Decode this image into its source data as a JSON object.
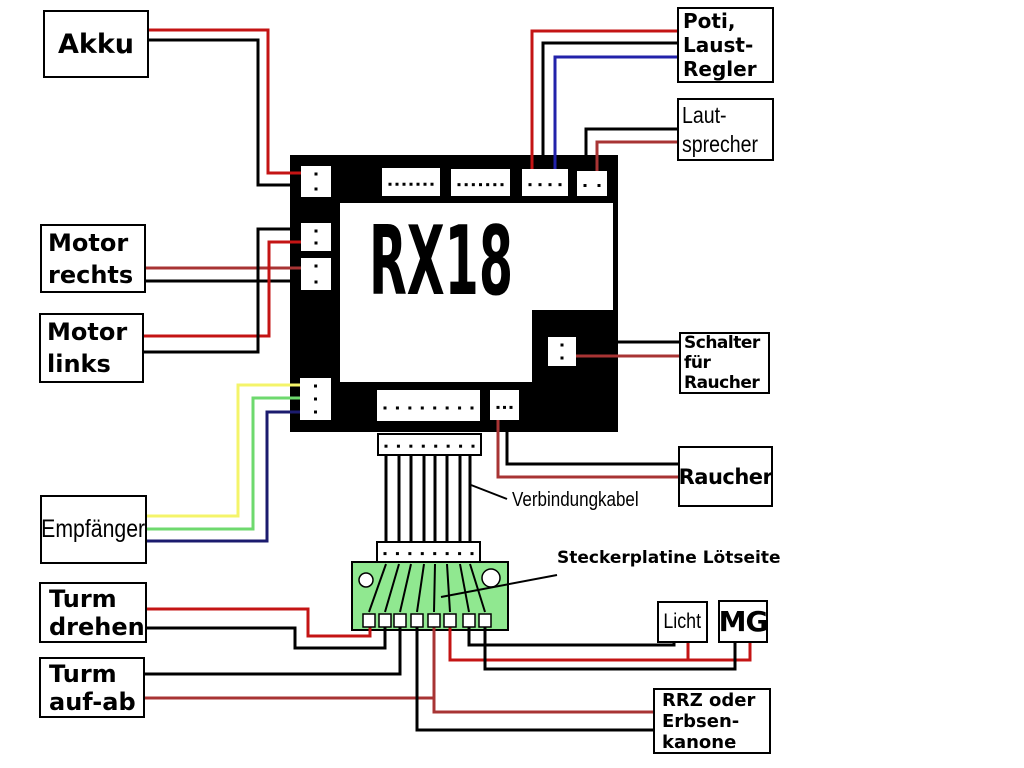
{
  "board": {
    "label": "RX18"
  },
  "boxes": {
    "akku": {
      "lines": [
        "Akku"
      ]
    },
    "poti": {
      "lines": [
        "Poti,",
        "Laust-",
        "Regler"
      ]
    },
    "lautsprecher": {
      "lines": [
        "Laut-",
        "sprecher"
      ]
    },
    "motor_rechts": {
      "lines": [
        "Motor",
        "rechts"
      ]
    },
    "motor_links": {
      "lines": [
        "Motor",
        "links"
      ]
    },
    "schalter_raucher": {
      "lines": [
        "Schalter",
        "für",
        "Raucher"
      ]
    },
    "raucher": {
      "lines": [
        "Raucher"
      ]
    },
    "empfaenger": {
      "lines": [
        "Empfänger"
      ]
    },
    "turm_drehen": {
      "lines": [
        "Turm",
        "drehen"
      ]
    },
    "turm_aufab": {
      "lines": [
        "Turm",
        "auf-ab"
      ]
    },
    "licht": {
      "lines": [
        "Licht"
      ]
    },
    "mg": {
      "lines": [
        "MG"
      ]
    },
    "rrz": {
      "lines": [
        "RRZ oder",
        "Erbsen-",
        "kanone"
      ]
    }
  },
  "annotations": {
    "cable_label": "Verbindungkabel",
    "pcb_label_line1": "Steckerplatine",
    "pcb_label_line2": "Lötseite"
  },
  "colors": {
    "red": "#c41414",
    "dark_red": "#a83434",
    "blue": "#2222aa",
    "navy": "#1b1b6e",
    "yellow": "#f4f46a",
    "green": "#6ed96e",
    "black": "#000000",
    "pcb_green": "#90e890",
    "white": "#ffffff"
  },
  "connectors": [
    {
      "name": "akku-connector",
      "x": 301,
      "y": 166,
      "w": 30,
      "h": 31,
      "pins": 2,
      "orient": "v"
    },
    {
      "name": "top-connector-1",
      "x": 382,
      "y": 168,
      "w": 58,
      "h": 28,
      "pins": 7,
      "orient": "h"
    },
    {
      "name": "top-connector-2",
      "x": 451,
      "y": 169,
      "w": 59,
      "h": 27,
      "pins": 7,
      "orient": "h"
    },
    {
      "name": "poti-connector",
      "x": 522,
      "y": 169,
      "w": 46,
      "h": 27,
      "pins": 4,
      "orient": "h"
    },
    {
      "name": "lautsprecher-connector",
      "x": 577,
      "y": 171,
      "w": 30,
      "h": 25,
      "pins": 2,
      "orient": "h"
    },
    {
      "name": "motor-rechts-connector",
      "x": 301,
      "y": 223,
      "w": 30,
      "h": 28,
      "pins": 2,
      "orient": "v"
    },
    {
      "name": "motor-links-connector",
      "x": 301,
      "y": 258,
      "w": 30,
      "h": 32,
      "pins": 2,
      "orient": "v"
    },
    {
      "name": "empfaenger-connector",
      "x": 300,
      "y": 378,
      "w": 31,
      "h": 42,
      "pins": 3,
      "orient": "v"
    },
    {
      "name": "schalter-connector",
      "x": 548,
      "y": 337,
      "w": 28,
      "h": 29,
      "pins": 2,
      "orient": "v"
    },
    {
      "name": "bottom-connector-long",
      "x": 377,
      "y": 390,
      "w": 103,
      "h": 31,
      "pins": 8,
      "orient": "h"
    },
    {
      "name": "bottom-connector-small",
      "x": 490,
      "y": 390,
      "w": 29,
      "h": 30,
      "pins": 3,
      "orient": "h"
    }
  ],
  "wires": [
    {
      "name": "wire-akku-red",
      "color": "red",
      "points": [
        [
          148,
          30
        ],
        [
          268,
          30
        ],
        [
          268,
          173
        ],
        [
          303,
          173
        ]
      ]
    },
    {
      "name": "wire-akku-black",
      "color": "black",
      "points": [
        [
          148,
          40
        ],
        [
          258,
          40
        ],
        [
          258,
          185
        ],
        [
          303,
          185
        ]
      ]
    },
    {
      "name": "wire-poti-red",
      "color": "red",
      "points": [
        [
          678,
          31
        ],
        [
          532,
          31
        ],
        [
          532,
          170
        ]
      ]
    },
    {
      "name": "wire-poti-black",
      "color": "black",
      "points": [
        [
          678,
          43
        ],
        [
          543,
          43
        ],
        [
          543,
          170
        ]
      ]
    },
    {
      "name": "wire-poti-blue",
      "color": "blue",
      "points": [
        [
          678,
          57
        ],
        [
          555,
          57
        ],
        [
          555,
          170
        ]
      ]
    },
    {
      "name": "wire-lautsprecher-black",
      "color": "black",
      "points": [
        [
          678,
          129
        ],
        [
          586,
          129
        ],
        [
          586,
          172
        ]
      ]
    },
    {
      "name": "wire-lautsprecher-red",
      "color": "dark_red",
      "points": [
        [
          678,
          142
        ],
        [
          597,
          142
        ],
        [
          597,
          172
        ]
      ]
    },
    {
      "name": "wire-motor-rechts-red",
      "color": "dark_red",
      "points": [
        [
          145,
          268
        ],
        [
          303,
          268
        ]
      ]
    },
    {
      "name": "wire-motor-rechts-black",
      "color": "black",
      "points": [
        [
          145,
          281
        ],
        [
          303,
          281
        ]
      ]
    },
    {
      "name": "wire-motor-links-red",
      "color": "red",
      "points": [
        [
          142,
          336
        ],
        [
          269,
          336
        ],
        [
          269,
          242
        ],
        [
          303,
          242
        ]
      ]
    },
    {
      "name": "wire-motor-links-black",
      "color": "black",
      "points": [
        [
          142,
          352
        ],
        [
          258,
          352
        ],
        [
          258,
          229
        ],
        [
          303,
          229
        ]
      ]
    },
    {
      "name": "wire-schalter-black",
      "color": "black",
      "points": [
        [
          617,
          342
        ],
        [
          679,
          342
        ]
      ]
    },
    {
      "name": "wire-schalter-red",
      "color": "dark_red",
      "points": [
        [
          576,
          356
        ],
        [
          679,
          356
        ]
      ]
    },
    {
      "name": "wire-raucher-black",
      "color": "black",
      "points": [
        [
          507,
          428
        ],
        [
          507,
          464
        ],
        [
          678,
          464
        ]
      ]
    },
    {
      "name": "wire-raucher-red",
      "color": "dark_red",
      "points": [
        [
          498,
          418
        ],
        [
          498,
          477
        ],
        [
          678,
          477
        ]
      ]
    },
    {
      "name": "wire-empfaenger-yellow",
      "color": "yellow",
      "points": [
        [
          146,
          516
        ],
        [
          238,
          516
        ],
        [
          238,
          385
        ],
        [
          302,
          385
        ]
      ]
    },
    {
      "name": "wire-empfaenger-green",
      "color": "green",
      "points": [
        [
          146,
          529
        ],
        [
          253,
          529
        ],
        [
          253,
          398
        ],
        [
          302,
          398
        ]
      ]
    },
    {
      "name": "wire-empfaenger-blue",
      "color": "navy",
      "points": [
        [
          146,
          541
        ],
        [
          267,
          541
        ],
        [
          267,
          412
        ],
        [
          302,
          412
        ]
      ]
    },
    {
      "name": "wire-turm-drehen-red",
      "color": "red",
      "points": [
        [
          146,
          609
        ],
        [
          308,
          609
        ],
        [
          308,
          636
        ],
        [
          370,
          636
        ],
        [
          370,
          624
        ]
      ]
    },
    {
      "name": "wire-turm-drehen-black",
      "color": "black",
      "points": [
        [
          146,
          628
        ],
        [
          295,
          628
        ],
        [
          295,
          648
        ],
        [
          385,
          648
        ],
        [
          385,
          624
        ]
      ]
    },
    {
      "name": "wire-turm-aufab-black",
      "color": "black",
      "points": [
        [
          142,
          674
        ],
        [
          400,
          674
        ],
        [
          400,
          624
        ]
      ]
    },
    {
      "name": "wire-turm-aufab-red",
      "color": "dark_red",
      "points": [
        [
          142,
          698
        ],
        [
          434,
          698
        ]
      ]
    },
    {
      "name": "wire-rrz-red",
      "color": "dark_red",
      "points": [
        [
          434,
          624
        ],
        [
          434,
          712
        ],
        [
          655,
          712
        ]
      ]
    },
    {
      "name": "wire-rrz-black",
      "color": "black",
      "points": [
        [
          417,
          624
        ],
        [
          417,
          730
        ],
        [
          655,
          730
        ]
      ]
    },
    {
      "name": "wire-licht-mg-red",
      "color": "red",
      "points": [
        [
          450,
          624
        ],
        [
          450,
          660
        ],
        [
          750,
          660
        ],
        [
          750,
          641
        ]
      ]
    },
    {
      "name": "wire-licht-red-riser",
      "color": "red",
      "points": [
        [
          688,
          641
        ],
        [
          688,
          660
        ]
      ]
    },
    {
      "name": "wire-licht-black",
      "color": "black",
      "points": [
        [
          469,
          624
        ],
        [
          469,
          645
        ],
        [
          674,
          645
        ],
        [
          674,
          641
        ]
      ]
    },
    {
      "name": "wire-mg-black",
      "color": "black",
      "points": [
        [
          485,
          624
        ],
        [
          485,
          669
        ],
        [
          735,
          669
        ],
        [
          735,
          641
        ]
      ]
    }
  ],
  "ribbon": {
    "top_strip": {
      "x": 378,
      "y": 434,
      "w": 103,
      "h": 21
    },
    "bottom_strip": {
      "x": 377,
      "y": 542,
      "w": 103,
      "h": 20
    },
    "pins": 8,
    "wire_x": [
      386,
      399,
      411,
      424,
      435,
      447,
      460,
      470
    ],
    "wire_y1": 454,
    "wire_y2": 543
  },
  "pcb": {
    "x": 352,
    "y": 562,
    "w": 156,
    "h": 68,
    "holes": [
      {
        "cx": 366,
        "cy": 580,
        "r": 7
      },
      {
        "cx": 491,
        "cy": 578,
        "r": 9
      }
    ],
    "trace_top_x": [
      386,
      399,
      411,
      424,
      435,
      447,
      460,
      470
    ],
    "trace_y1": 564,
    "trace_y2": 612,
    "pads_cx": [
      369,
      385,
      400,
      417,
      434,
      450,
      469,
      485
    ],
    "pad_y": 614,
    "pad_w": 12,
    "pad_h": 13
  },
  "pointers": [
    {
      "name": "cable-pointer-line",
      "points": [
        [
          471,
          485
        ],
        [
          507,
          499
        ]
      ]
    },
    {
      "name": "pcb-pointer-line",
      "points": [
        [
          441,
          597
        ],
        [
          557,
          575
        ]
      ]
    }
  ]
}
